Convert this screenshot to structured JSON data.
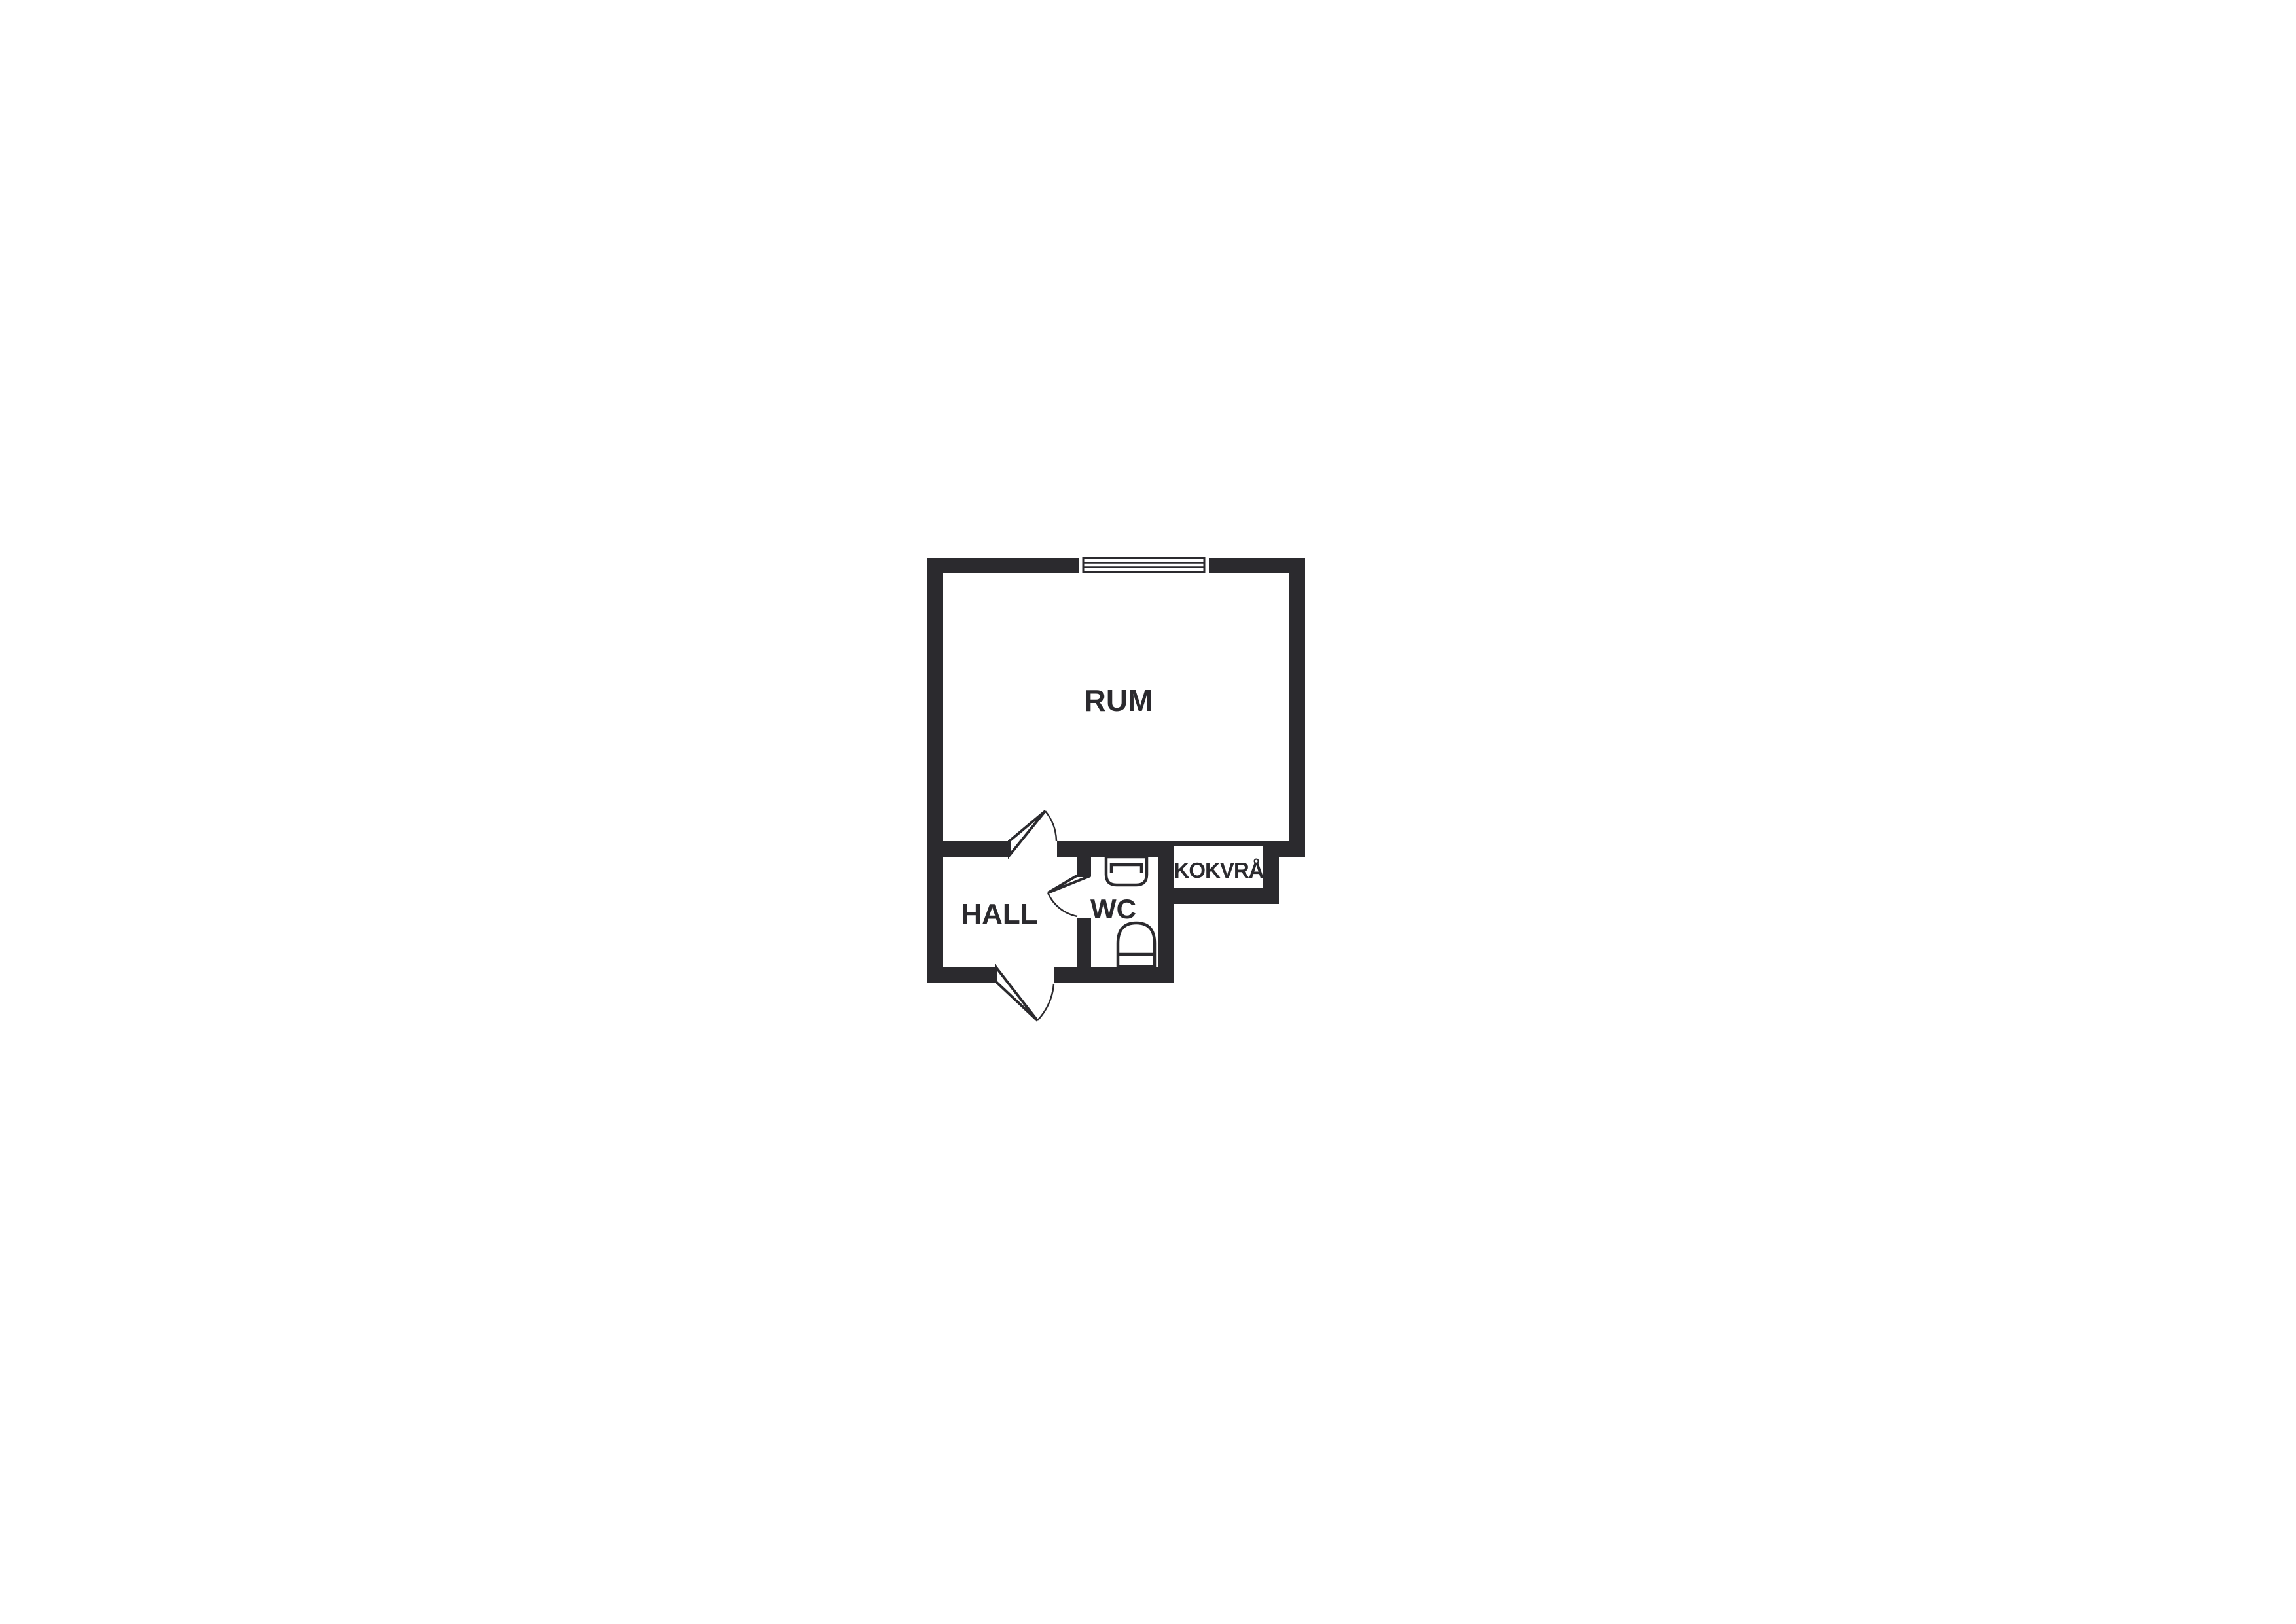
{
  "canvas": {
    "background": "#ffffff",
    "ink": "#2b2a2e"
  },
  "floor_plan": {
    "kind": "apartment-floor-plan",
    "rooms": {
      "rum": {
        "label": "RUM"
      },
      "hall": {
        "label": "HALL"
      },
      "wc": {
        "label": "WC"
      },
      "kokvra": {
        "label": "KOKVRÅ"
      }
    },
    "fixtures": {
      "window": "window-icon",
      "room_door": "door-swing-icon",
      "wc_door": "door-swing-icon",
      "entrance_door": "door-swing-icon",
      "sink": "sink-icon",
      "toilet": "toilet-icon"
    }
  }
}
